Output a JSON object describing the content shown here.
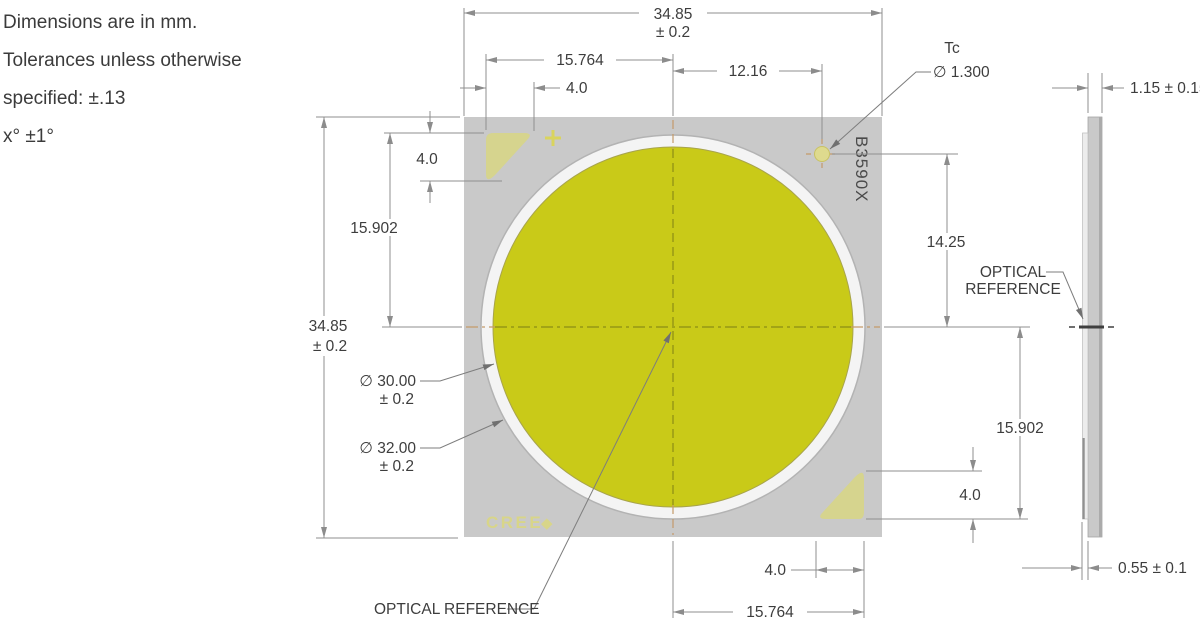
{
  "notes": {
    "lines": [
      "Dimensions are in mm.",
      "Tolerances unless otherwise",
      "specified: ±.13",
      "x° ±1°"
    ]
  },
  "front_view": {
    "marking": {
      "part_number": "B3590X",
      "brand": "CREE",
      "brand_symbol": "◆"
    },
    "tc": {
      "label": "Tc",
      "diameter": "∅ 1.300"
    },
    "optical_reference": "OPTICAL REFERENCE",
    "dimensions": {
      "overall_width": "34.85",
      "overall_width_tol": "± 0.2",
      "overall_height": "34.85",
      "overall_height_tol": "± 0.2",
      "pad_edge_to_center_top": "15.764",
      "center_to_tc": "12.16",
      "pad_width_top": "4.0",
      "pad_height_left": "4.0",
      "pad_top_to_center": "15.902",
      "tc_to_center": "14.25",
      "center_to_pad_bottom": "15.902",
      "pad_height_right": "4.0",
      "pad_width_bottom": "4.0",
      "pad_edge_to_center_bottom": "15.764",
      "les_diameter": "∅ 30.00",
      "les_diameter_tol": "± 0.2",
      "outer_ring_diameter": "∅ 32.00",
      "outer_ring_diameter_tol": "± 0.2"
    }
  },
  "side_view": {
    "thickness": "1.15 ± 0.15",
    "ring_height": "0.55 ± 0.1",
    "optical_reference": {
      "line1": "OPTICAL",
      "line2": "REFERENCE"
    }
  },
  "colors": {
    "body": "#c9c9c9",
    "les": "#c9ca18",
    "ring": "#f4f4f4",
    "pad": "#d6d48e",
    "dim_line": "#8f8f8f",
    "dim_text": "#3d3d3d",
    "centerline_outer": "#c49a6a",
    "centerline_inner": "#8b8d16",
    "marking_text": "#4a4a4a",
    "brand_text": "#dcd97a"
  }
}
